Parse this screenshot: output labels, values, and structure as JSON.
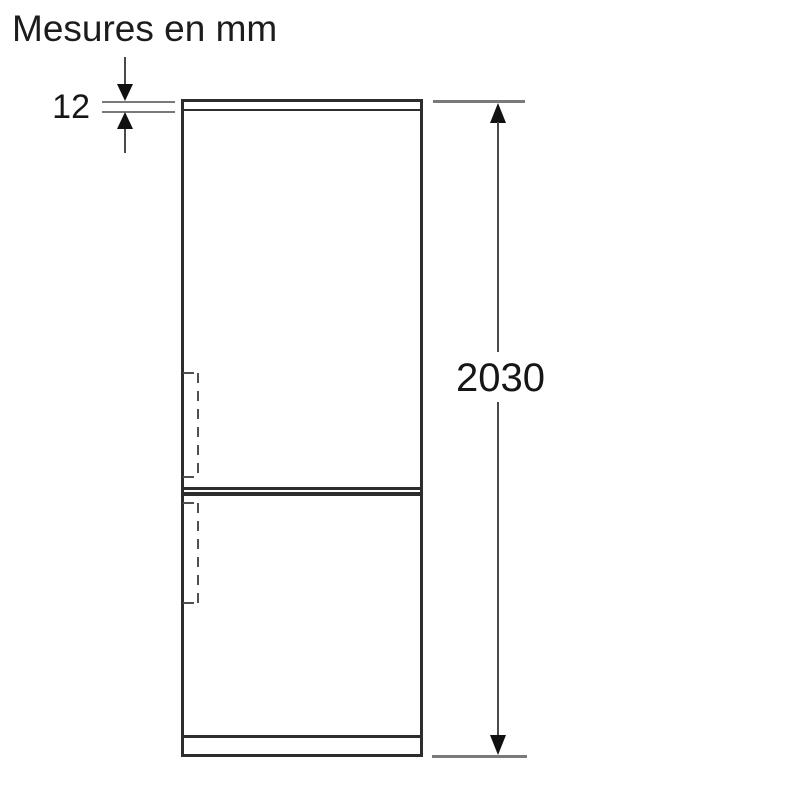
{
  "title": "Mesures en mm",
  "diagram": {
    "subject": "refrigerator-front-elevation-dimension-drawing",
    "dimensions": {
      "top_panel": {
        "label": "12",
        "orientation": "vertical",
        "unit": "mm"
      },
      "overall_height": {
        "label": "2030",
        "orientation": "vertical",
        "unit": "mm"
      }
    }
  },
  "colors": {
    "background": "#ffffff",
    "outline": "#2d2d2d",
    "extension_line": "#7a7a7a",
    "dimension_line": "#4a4a4a",
    "arrowhead": "#111111",
    "text": "#1c1c1c"
  }
}
